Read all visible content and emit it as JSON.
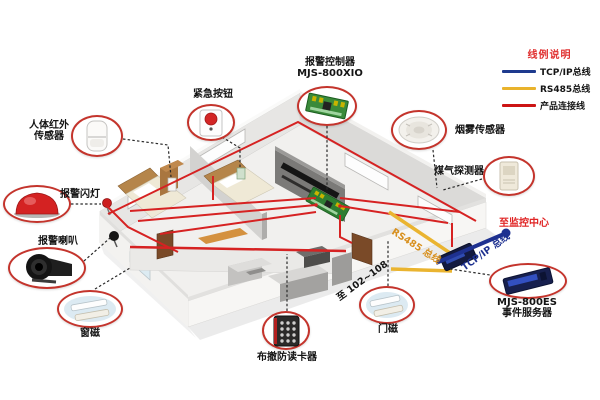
{
  "legend": {
    "title": "线例说明",
    "items": [
      {
        "label": "TCP/IP总线",
        "color": "#1e3a8e"
      },
      {
        "label": "RS485总线",
        "color": "#e9b32c"
      },
      {
        "label": "产品连接线",
        "color": "#cc1414"
      }
    ]
  },
  "devices": [
    {
      "id": "alarm-controller",
      "label": "报警控制器",
      "label2": "MJS-800XIO"
    },
    {
      "id": "emergency-button",
      "label": "紧急按钮"
    },
    {
      "id": "pir-sensor",
      "label": "人体红外",
      "label2": "传感器"
    },
    {
      "id": "alarm-strobe",
      "label": "报警闪灯"
    },
    {
      "id": "alarm-siren",
      "label": "报警喇叭"
    },
    {
      "id": "window-contact",
      "label": "窗磁"
    },
    {
      "id": "card-reader",
      "label": "布撤防读卡器"
    },
    {
      "id": "door-contact",
      "label": "门磁"
    },
    {
      "id": "smoke-sensor",
      "label": "烟雾传感器"
    },
    {
      "id": "gas-detector",
      "label": "煤气探测器"
    },
    {
      "id": "event-server",
      "label": "MJS-800ES",
      "label2": "事件服务器"
    }
  ],
  "annotations": {
    "monitor_center": "至监控中心",
    "rs485_bus": "RS485 总线",
    "tcpip_bus": "TCP/IP 总线",
    "to_rooms": "至 102~108"
  },
  "colors": {
    "tcpip_line": "#1e3190",
    "rs485_line": "#eab430",
    "product_line": "#d62222",
    "callout_circle": "#c4342c",
    "red_text": "#e02525"
  }
}
